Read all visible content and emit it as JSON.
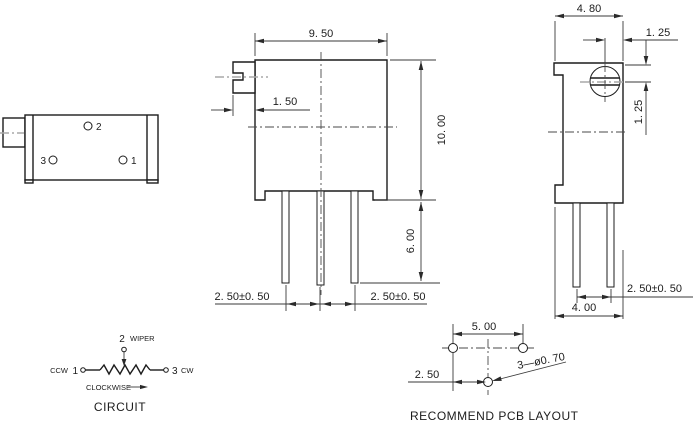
{
  "back_view": {
    "terminal_2": "2",
    "terminal_3": "3",
    "terminal_1": "1"
  },
  "front_view": {
    "dim_width": "9. 50",
    "dim_adjuster_offset": "1. 50",
    "dim_height": "10. 00",
    "dim_pin_length": "6. 00",
    "dim_pin_pitch_left": "2. 50±0. 50",
    "dim_pin_pitch_right": "2. 50±0. 50"
  },
  "side_view": {
    "dim_depth": "4. 80",
    "dim_screw_center_h": "1. 25",
    "dim_screw_center_v": "1. 25",
    "dim_pin_pitch": "2. 50±0. 50",
    "dim_base_width": "4. 00"
  },
  "circuit": {
    "terminal_2": "2",
    "wiper": "WIPER",
    "ccw": "CCW",
    "terminal_1": "1",
    "terminal_3": "3",
    "cw": "CW",
    "clockwise": "CLOCKWISE",
    "title": "CIRCUIT"
  },
  "pcb_layout": {
    "dim_hole_pitch": "5. 00",
    "dim_hole_offset": "2. 50",
    "hole_spec": "3—ø0. 70",
    "title": "RECOMMEND PCB LAYOUT"
  }
}
